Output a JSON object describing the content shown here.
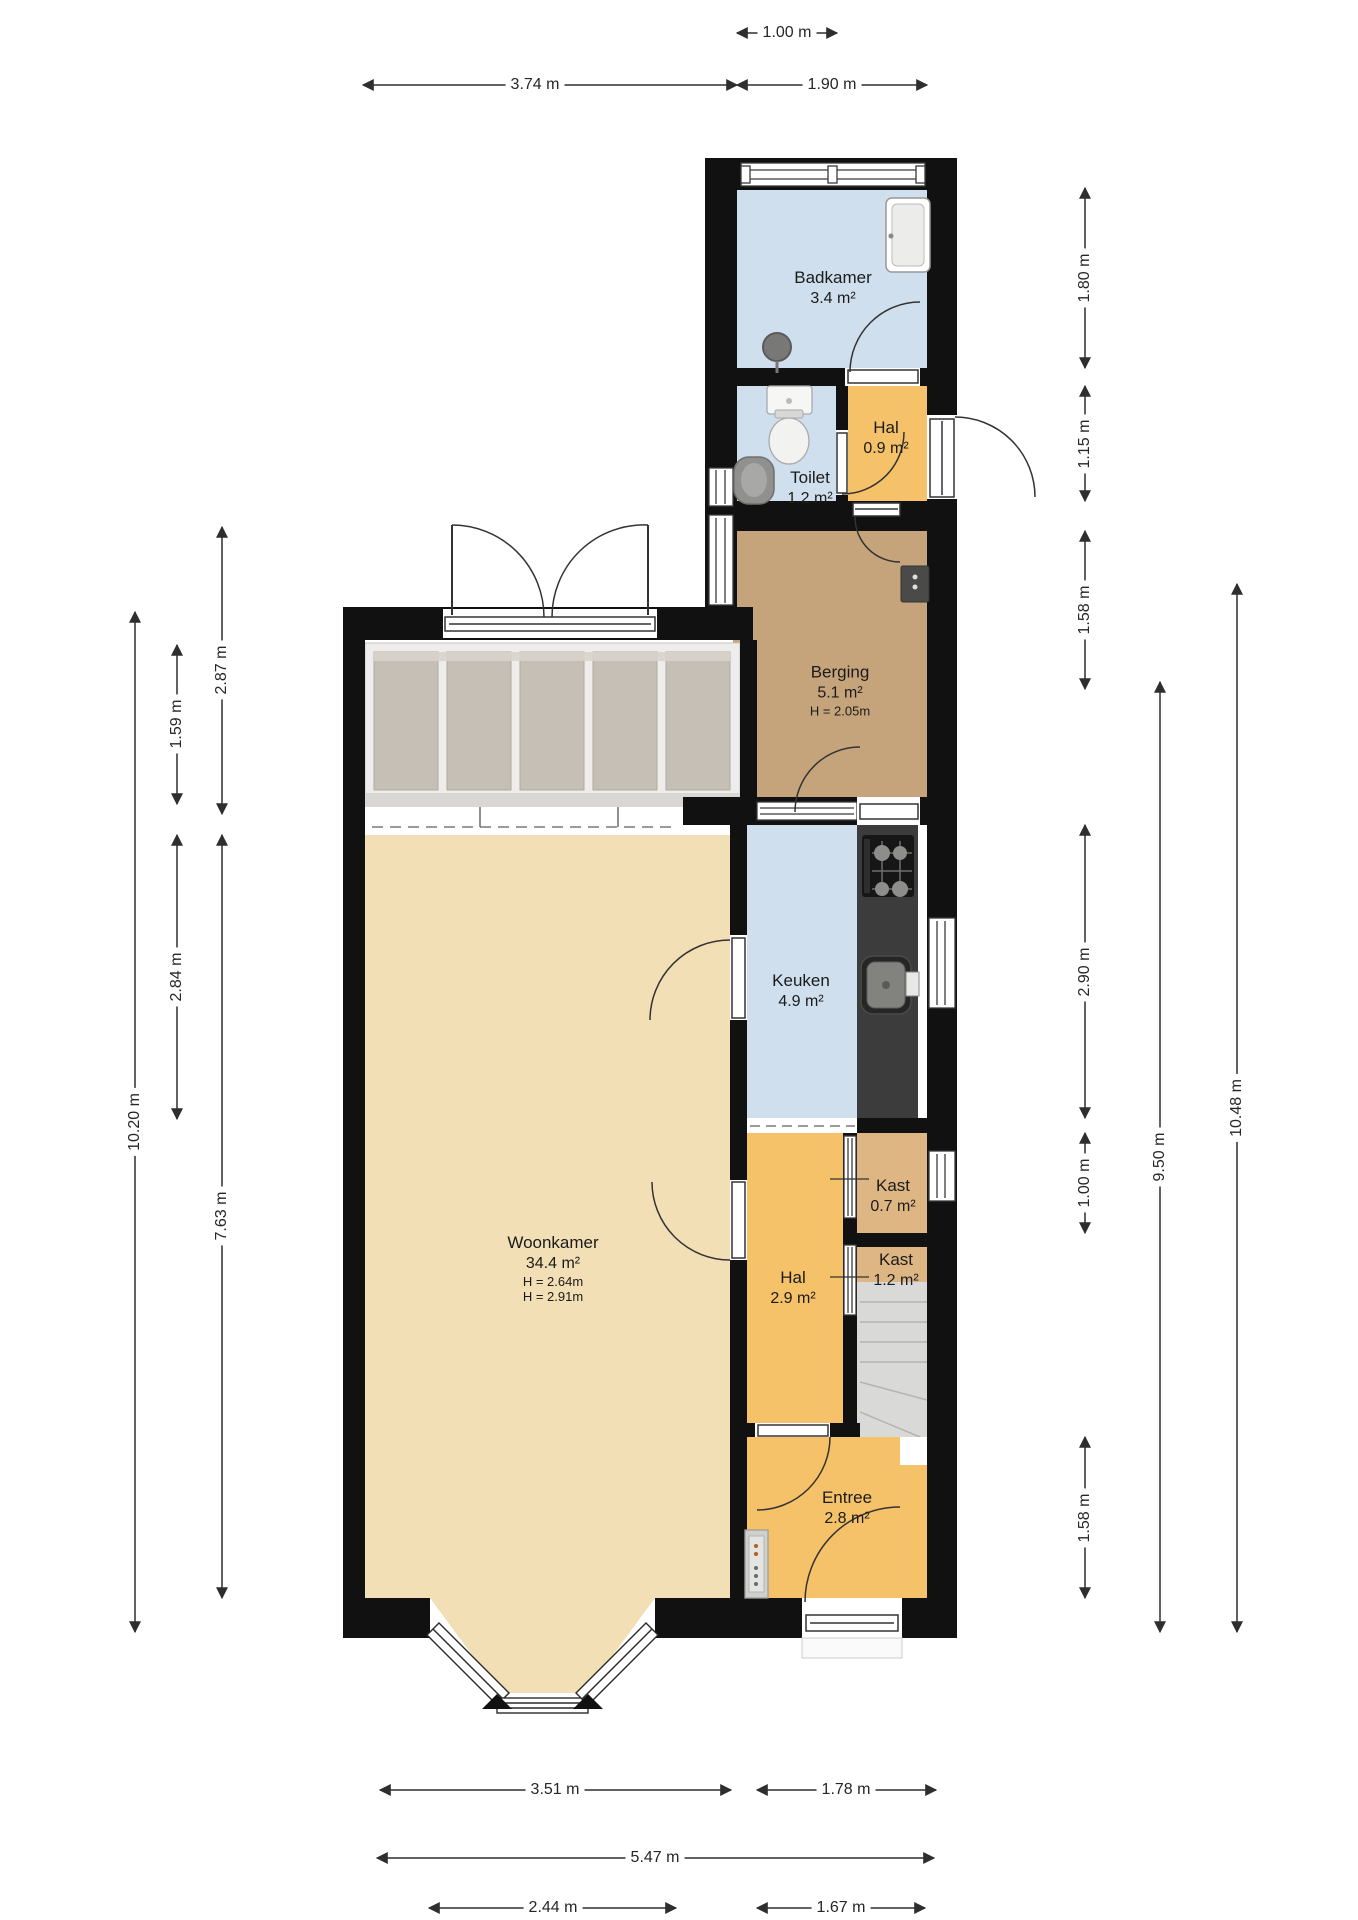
{
  "plan": {
    "title": "Floor plan ground floor",
    "rooms": {
      "badkamer": {
        "name": "Badkamer",
        "area": "3.4 m²"
      },
      "toilet": {
        "name": "Toilet",
        "area": "1.2 m²"
      },
      "hal_boven": {
        "name": "Hal",
        "area": "0.9 m²"
      },
      "berging": {
        "name": "Berging",
        "area": "5.1 m²",
        "height": "H = 2.05m"
      },
      "keuken": {
        "name": "Keuken",
        "area": "4.9 m²"
      },
      "woonkamer": {
        "name": "Woonkamer",
        "area": "34.4 m²",
        "height1": "H = 2.64m",
        "height2": "H = 2.91m"
      },
      "kast_boven": {
        "name": "Kast",
        "area": "0.7 m²"
      },
      "kast_onder": {
        "name": "Kast",
        "area": "1.2 m²"
      },
      "hal": {
        "name": "Hal",
        "area": "2.9 m²"
      },
      "entree": {
        "name": "Entree",
        "area": "2.8 m²"
      }
    },
    "dimensions": {
      "top_inner": "1.00 m",
      "top_left": "3.74 m",
      "top_right": "1.90 m",
      "right_badkamer": "1.80 m",
      "right_toilet": "1.15 m",
      "right_berging": "1.58 m",
      "right_keuken": "2.90 m",
      "right_kast": "1.00 m",
      "right_entree": "1.58 m",
      "right_total_inner": "9.50 m",
      "right_total_outer": "10.48 m",
      "left_serre_outer": "2.87 m",
      "left_serre_inner": "1.59 m",
      "left_total": "10.20 m",
      "left_woonkamer": "7.63 m",
      "left_woonkamer_boven": "2.84 m",
      "bottom_woonkamer": "3.51 m",
      "bottom_entree": "1.78 m",
      "bottom_total": "5.47 m",
      "bottom_erker": "2.44 m",
      "bottom_voordeur": "1.67 m"
    },
    "colors": {
      "wet_room_blue": "#cfdfee",
      "hall_orange": "#f5c169",
      "storage_tan": "#c6a47b",
      "closet_tan": "#ddb684",
      "living_beige": "#f2dfb5",
      "counter_dark": "#3c3c3c",
      "wall_black": "#111111"
    }
  }
}
